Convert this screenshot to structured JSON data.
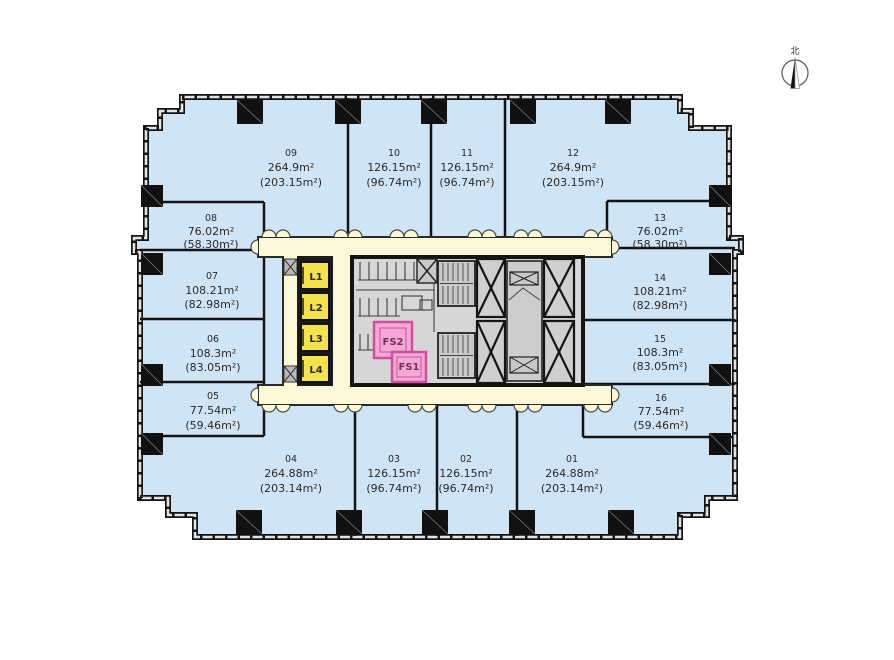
{
  "compass": {
    "label": "北"
  },
  "units": [
    {
      "id": "01",
      "area": "264.88m²",
      "gross": "(203.14m²)"
    },
    {
      "id": "02",
      "area": "126.15m²",
      "gross": "(96.74m²)"
    },
    {
      "id": "03",
      "area": "126.15m²",
      "gross": "(96.74m²)"
    },
    {
      "id": "04",
      "area": "264.88m²",
      "gross": "(203.14m²)"
    },
    {
      "id": "05",
      "area": "77.54m²",
      "gross": "(59.46m²)"
    },
    {
      "id": "06",
      "area": "108.3m²",
      "gross": "(83.05m²)"
    },
    {
      "id": "07",
      "area": "108.21m²",
      "gross": "(82.98m²)"
    },
    {
      "id": "08",
      "area": "76.02m²",
      "gross": "(58.30m²)"
    },
    {
      "id": "09",
      "area": "264.9m²",
      "gross": "(203.15m²)"
    },
    {
      "id": "10",
      "area": "126.15m²",
      "gross": "(96.74m²)"
    },
    {
      "id": "11",
      "area": "126.15m²",
      "gross": "(96.74m²)"
    },
    {
      "id": "12",
      "area": "264.9m²",
      "gross": "(203.15m²)"
    },
    {
      "id": "13",
      "area": "76.02m²",
      "gross": "(58.30m²)"
    },
    {
      "id": "14",
      "area": "108.21m²",
      "gross": "(82.98m²)"
    },
    {
      "id": "15",
      "area": "108.3m²",
      "gross": "(83.05m²)"
    },
    {
      "id": "16",
      "area": "77.54m²",
      "gross": "(59.46m²)"
    }
  ],
  "core": {
    "elevators": [
      {
        "label": "L1"
      },
      {
        "label": "L2"
      },
      {
        "label": "L3"
      },
      {
        "label": "L4"
      }
    ],
    "fire_stairs": [
      {
        "label": "FS2"
      },
      {
        "label": "FS1"
      }
    ]
  },
  "colors": {
    "room": "#cfe5f6",
    "corridor": "#faf8d7",
    "elevator": "#f3e24b",
    "firestair": "#f3a9d4",
    "firestair-border": "#cf4fa0",
    "core": "#d6d6d6",
    "fixture": "#c9c9c9",
    "wall": "#141414",
    "text": "#2b2b2b"
  }
}
